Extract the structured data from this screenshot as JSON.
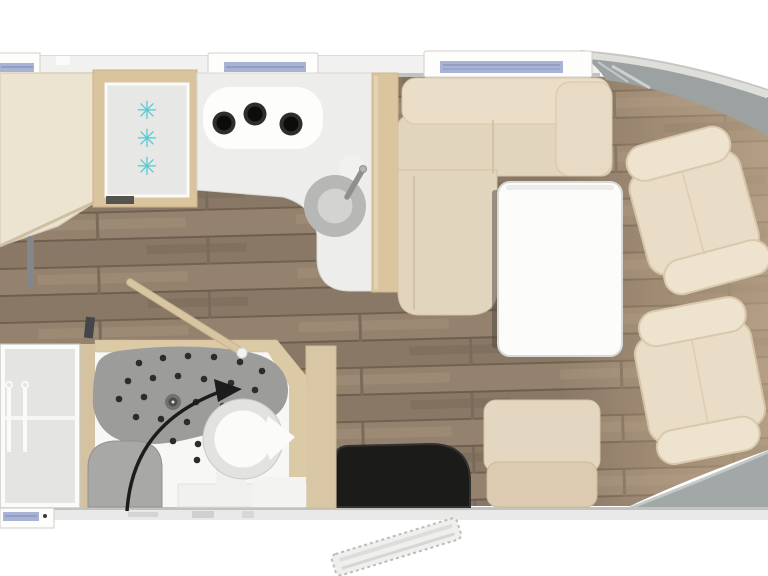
{
  "diagram": {
    "type": "motorhome-floorplan-top-view",
    "orientation": "cab-at-right, rear cut off at left",
    "areas": [
      {
        "name": "rear-bed"
      },
      {
        "name": "fridge-freezer",
        "snowflake_count": 3
      },
      {
        "name": "kitchen",
        "hob_burners": 3,
        "sink": 1
      },
      {
        "name": "dinette-sofa"
      },
      {
        "name": "table"
      },
      {
        "name": "swivel-pilot-seats",
        "count": 2
      },
      {
        "name": "side-bench-seat"
      },
      {
        "name": "entry-mat"
      },
      {
        "name": "entry-step-outside"
      },
      {
        "name": "bathroom",
        "features": [
          "shower-tray",
          "swivel-toilet",
          "shower-seat",
          "rotation-arrow"
        ]
      },
      {
        "name": "wardrobe",
        "hangers": 2
      },
      {
        "name": "swivel-wall-open"
      }
    ],
    "windows": {
      "top_wall": 3,
      "bottom_wall": 1
    }
  },
  "fridge": {
    "snowflakes": [
      "✳",
      "✳",
      "✳"
    ]
  },
  "colors": {
    "background": "#ffffff",
    "wall_band": "#efefee",
    "wall_line": "#c2c2c0",
    "wood_floor": "#8e7c6a",
    "cab_floor_light": "#c2a98b",
    "cab_gray": "#9ca2a2",
    "furniture_cream": "#e5d8c2",
    "cabinet_tan": "#d9c49e",
    "counter_gray": "#ededec",
    "hob_white": "#fdfdfc",
    "burner_black": "#0c0c0a",
    "sink_gray": "#b7b7b5",
    "freezer_panel": "#e7e7e5",
    "snowflake_cyan": "#54cbd5",
    "window_glass": "#a9b3d6",
    "bathroom_white": "#f7f7f5",
    "shower_gray": "#9c9c9a",
    "toilet_ring": "#e2e2e0",
    "mat_black": "#1b1b19",
    "arrow_black": "#1c1c1c",
    "table_white": "#fcfcfb",
    "wardrobe_gray": "#e4e4e2"
  }
}
